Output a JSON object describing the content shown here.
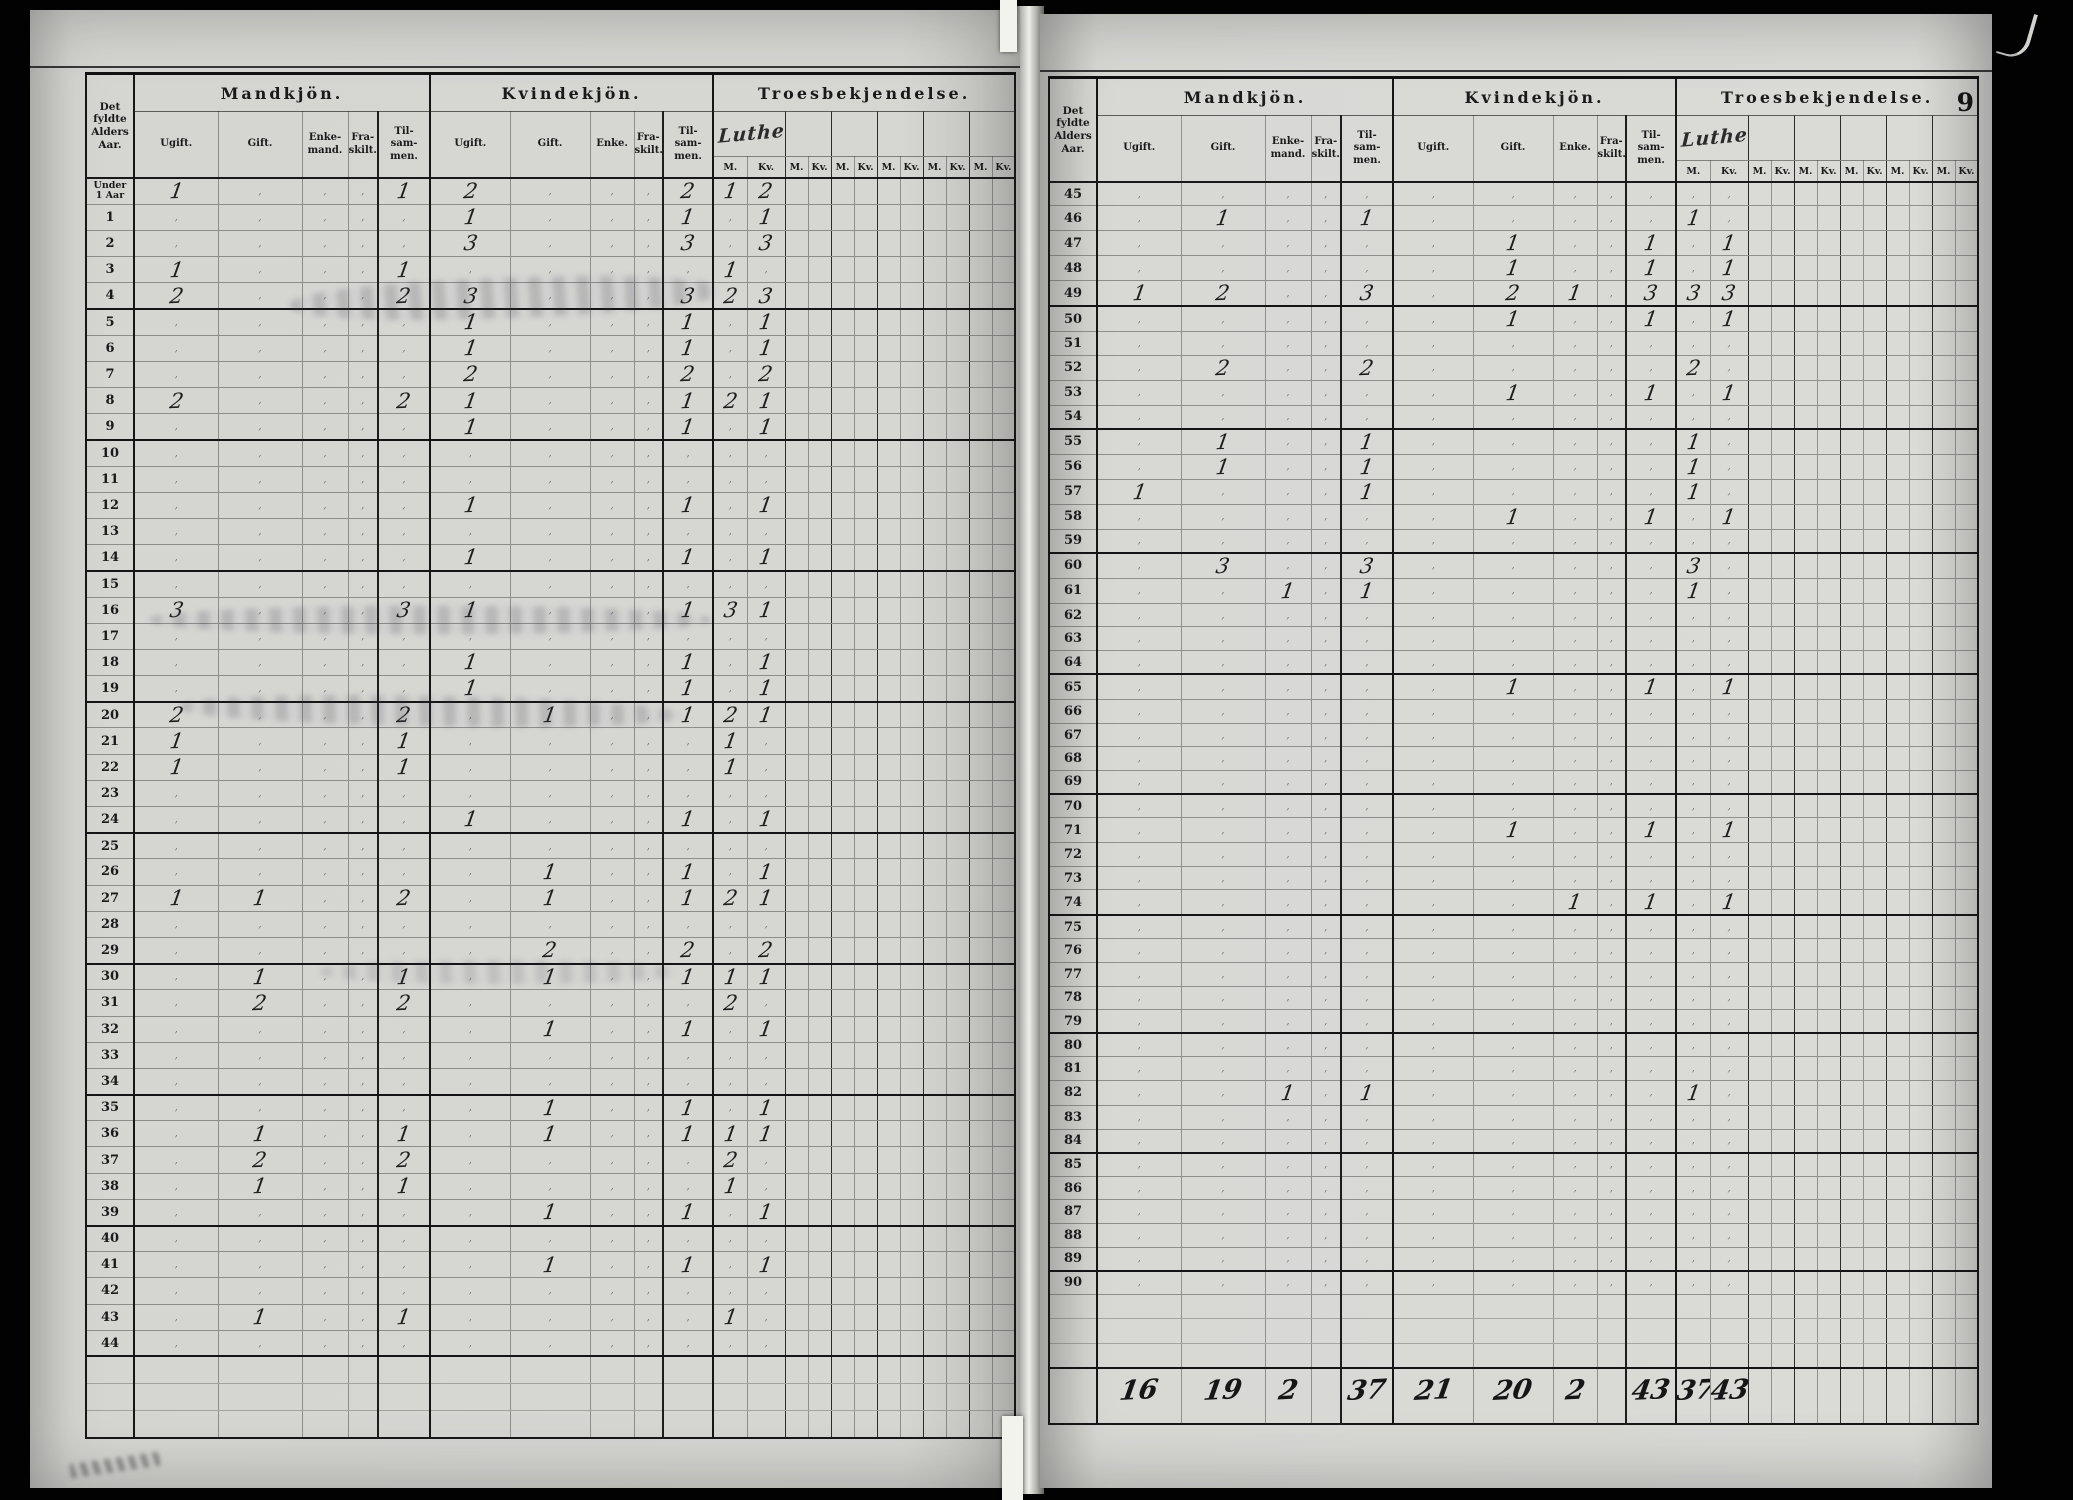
{
  "document": {
    "page_number": "9",
    "age_column_header": "Det\nfyldte\nAlders\nAar.",
    "groups": {
      "male": "Mandkjön.",
      "female": "Kvindekjön.",
      "religion": "Troesbekjendelse."
    },
    "male_subcolumns": [
      "Ugift.",
      "Gift.",
      "Enke-\nmand.",
      "Fra-\nskilt.",
      "Til-\nsam-\nmen."
    ],
    "female_subcolumns": [
      "Ugift.",
      "Gift.",
      "Enke.",
      "Fra-\nskilt.",
      "Til-\nsam-\nmen."
    ],
    "religion_written_label": "Lutheraner",
    "religion_pair_headers": [
      "M.",
      "Kv."
    ],
    "religion_extra_pairs": 5
  },
  "left_page": {
    "rows": [
      {
        "l": "Under\n1 Aar",
        "v": [
          "1",
          "",
          "",
          "",
          "1",
          "2",
          "",
          "",
          "",
          "2",
          "1",
          "2"
        ]
      },
      {
        "l": "1",
        "v": [
          "",
          "",
          "",
          "",
          "",
          "1",
          "",
          "",
          "",
          "1",
          "",
          "1"
        ]
      },
      {
        "l": "2",
        "v": [
          "",
          "",
          "",
          "",
          "",
          "3",
          "",
          "",
          "",
          "3",
          "",
          "3"
        ]
      },
      {
        "l": "3",
        "v": [
          "1",
          "",
          "",
          "",
          "1",
          "",
          "",
          "",
          "",
          "",
          "1",
          ""
        ]
      },
      {
        "l": "4",
        "v": [
          "2",
          "",
          "",
          "",
          "2",
          "3",
          "",
          "",
          "",
          "3",
          "2",
          "3"
        ]
      },
      {
        "l": "5",
        "v": [
          "",
          "",
          "",
          "",
          "",
          "1",
          "",
          "",
          "",
          "1",
          "",
          "1"
        ]
      },
      {
        "l": "6",
        "v": [
          "",
          "",
          "",
          "",
          "",
          "1",
          "",
          "",
          "",
          "1",
          "",
          "1"
        ]
      },
      {
        "l": "7",
        "v": [
          "",
          "",
          "",
          "",
          "",
          "2",
          "",
          "",
          "",
          "2",
          "",
          "2"
        ]
      },
      {
        "l": "8",
        "v": [
          "2",
          "",
          "",
          "",
          "2",
          "1",
          "",
          "",
          "",
          "1",
          "2",
          "1"
        ]
      },
      {
        "l": "9",
        "v": [
          "",
          "",
          "",
          "",
          "",
          "1",
          "",
          "",
          "",
          "1",
          "",
          "1"
        ]
      },
      {
        "l": "10"
      },
      {
        "l": "11"
      },
      {
        "l": "12",
        "v": [
          "",
          "",
          "",
          "",
          "",
          "1",
          "",
          "",
          "",
          "1",
          "",
          "1"
        ]
      },
      {
        "l": "13"
      },
      {
        "l": "14",
        "v": [
          "",
          "",
          "",
          "",
          "",
          "1",
          "",
          "",
          "",
          "1",
          "",
          "1"
        ]
      },
      {
        "l": "15"
      },
      {
        "l": "16",
        "v": [
          "3",
          "",
          "",
          "",
          "3",
          "1",
          "",
          "",
          "",
          "1",
          "3",
          "1"
        ]
      },
      {
        "l": "17"
      },
      {
        "l": "18",
        "v": [
          "",
          "",
          "",
          "",
          "",
          "1",
          "",
          "",
          "",
          "1",
          "",
          "1"
        ]
      },
      {
        "l": "19",
        "v": [
          "",
          "",
          "",
          "",
          "",
          "1",
          "",
          "",
          "",
          "1",
          "",
          "1"
        ]
      },
      {
        "l": "20",
        "v": [
          "2",
          "",
          "",
          "",
          "2",
          "",
          "1",
          "",
          "",
          "1",
          "2",
          "1"
        ]
      },
      {
        "l": "21",
        "v": [
          "1",
          "",
          "",
          "",
          "1",
          "",
          "",
          "",
          "",
          "",
          "1",
          ""
        ]
      },
      {
        "l": "22",
        "v": [
          "1",
          "",
          "",
          "",
          "1",
          "",
          "",
          "",
          "",
          "",
          "1",
          ""
        ]
      },
      {
        "l": "23"
      },
      {
        "l": "24",
        "v": [
          "",
          "",
          "",
          "",
          "",
          "1",
          "",
          "",
          "",
          "1",
          "",
          "1"
        ]
      },
      {
        "l": "25"
      },
      {
        "l": "26",
        "v": [
          "",
          "",
          "",
          "",
          "",
          "",
          "1",
          "",
          "",
          "1",
          "",
          "1"
        ]
      },
      {
        "l": "27",
        "v": [
          "1",
          "1",
          "",
          "",
          "2",
          "",
          "1",
          "",
          "",
          "1",
          "2",
          "1"
        ]
      },
      {
        "l": "28"
      },
      {
        "l": "29",
        "v": [
          "",
          "",
          "",
          "",
          "",
          "",
          "2",
          "",
          "",
          "2",
          "",
          "2"
        ]
      },
      {
        "l": "30",
        "v": [
          "",
          "1",
          "",
          "",
          "1",
          "",
          "1",
          "",
          "",
          "1",
          "1",
          "1"
        ]
      },
      {
        "l": "31",
        "v": [
          "",
          "2",
          "",
          "",
          "2",
          "",
          "",
          "",
          "",
          "",
          "2",
          ""
        ]
      },
      {
        "l": "32",
        "v": [
          "",
          "",
          "",
          "",
          "",
          "",
          "1",
          "",
          "",
          "1",
          "",
          "1"
        ]
      },
      {
        "l": "33"
      },
      {
        "l": "34"
      },
      {
        "l": "35",
        "v": [
          "",
          "",
          "",
          "",
          "",
          "",
          "1",
          "",
          "",
          "1",
          "",
          "1"
        ]
      },
      {
        "l": "36",
        "v": [
          "",
          "1",
          "",
          "",
          "1",
          "",
          "1",
          "",
          "",
          "1",
          "1",
          "1"
        ]
      },
      {
        "l": "37",
        "v": [
          "",
          "2",
          "",
          "",
          "2",
          "",
          "",
          "",
          "",
          "",
          "2",
          ""
        ]
      },
      {
        "l": "38",
        "v": [
          "",
          "1",
          "",
          "",
          "1",
          "",
          "",
          "",
          "",
          "",
          "1",
          ""
        ]
      },
      {
        "l": "39",
        "v": [
          "",
          "",
          "",
          "",
          "",
          "",
          "1",
          "",
          "",
          "1",
          "",
          "1"
        ]
      },
      {
        "l": "40"
      },
      {
        "l": "41",
        "v": [
          "",
          "",
          "",
          "",
          "",
          "",
          "1",
          "",
          "",
          "1",
          "",
          "1"
        ]
      },
      {
        "l": "42"
      },
      {
        "l": "43",
        "v": [
          "",
          "1",
          "",
          "",
          "1",
          "",
          "",
          "",
          "",
          "",
          "1",
          ""
        ]
      },
      {
        "l": "44"
      }
    ]
  },
  "right_page": {
    "rows": [
      {
        "l": "45"
      },
      {
        "l": "46",
        "v": [
          "",
          "1",
          "",
          "",
          "1",
          "",
          "",
          "",
          "",
          "",
          "1",
          ""
        ]
      },
      {
        "l": "47",
        "v": [
          "",
          "",
          "",
          "",
          "",
          "",
          "1",
          "",
          "",
          "1",
          "",
          "1"
        ]
      },
      {
        "l": "48",
        "v": [
          "",
          "",
          "",
          "",
          "",
          "",
          "1",
          "",
          "",
          "1",
          "",
          "1"
        ]
      },
      {
        "l": "49",
        "v": [
          "1",
          "2",
          "",
          "",
          "3",
          "",
          "2",
          "1",
          "",
          "3",
          "3",
          "3"
        ]
      },
      {
        "l": "50",
        "v": [
          "",
          "",
          "",
          "",
          "",
          "",
          "1",
          "",
          "",
          "1",
          "",
          "1"
        ]
      },
      {
        "l": "51"
      },
      {
        "l": "52",
        "v": [
          "",
          "2",
          "",
          "",
          "2",
          "",
          "",
          "",
          "",
          "",
          "2",
          ""
        ]
      },
      {
        "l": "53",
        "v": [
          "",
          "",
          "",
          "",
          "",
          "",
          "1",
          "",
          "",
          "1",
          "",
          "1"
        ]
      },
      {
        "l": "54"
      },
      {
        "l": "55",
        "v": [
          "",
          "1",
          "",
          "",
          "1",
          "",
          "",
          "",
          "",
          "",
          "1",
          ""
        ]
      },
      {
        "l": "56",
        "v": [
          "",
          "1",
          "",
          "",
          "1",
          "",
          "",
          "",
          "",
          "",
          "1",
          ""
        ]
      },
      {
        "l": "57",
        "v": [
          "1",
          "",
          "",
          "",
          "1",
          "",
          "",
          "",
          "",
          "",
          "1",
          ""
        ]
      },
      {
        "l": "58",
        "v": [
          "",
          "",
          "",
          "",
          "",
          "",
          "1",
          "",
          "",
          "1",
          "",
          "1"
        ]
      },
      {
        "l": "59"
      },
      {
        "l": "60",
        "v": [
          "",
          "3",
          "",
          "",
          "3",
          "",
          "",
          "",
          "",
          "",
          "3",
          ""
        ]
      },
      {
        "l": "61",
        "v": [
          "",
          "",
          "1",
          "",
          "1",
          "",
          "",
          "",
          "",
          "",
          "1",
          ""
        ]
      },
      {
        "l": "62"
      },
      {
        "l": "63"
      },
      {
        "l": "64"
      },
      {
        "l": "65",
        "v": [
          "",
          "",
          "",
          "",
          "",
          "",
          "1",
          "",
          "",
          "1",
          "",
          "1"
        ]
      },
      {
        "l": "66"
      },
      {
        "l": "67"
      },
      {
        "l": "68"
      },
      {
        "l": "69"
      },
      {
        "l": "70"
      },
      {
        "l": "71",
        "v": [
          "",
          "",
          "",
          "",
          "",
          "",
          "1",
          "",
          "",
          "1",
          "",
          "1"
        ]
      },
      {
        "l": "72"
      },
      {
        "l": "73"
      },
      {
        "l": "74",
        "v": [
          "",
          "",
          "",
          "",
          "",
          "",
          "",
          "1",
          "",
          "1",
          "",
          "1"
        ]
      },
      {
        "l": "75"
      },
      {
        "l": "76"
      },
      {
        "l": "77"
      },
      {
        "l": "78"
      },
      {
        "l": "79"
      },
      {
        "l": "80"
      },
      {
        "l": "81"
      },
      {
        "l": "82",
        "v": [
          "",
          "",
          "1",
          "",
          "1",
          "",
          "",
          "",
          "",
          "",
          "1",
          ""
        ]
      },
      {
        "l": "83"
      },
      {
        "l": "84"
      },
      {
        "l": "85"
      },
      {
        "l": "86"
      },
      {
        "l": "87"
      },
      {
        "l": "88"
      },
      {
        "l": "89"
      },
      {
        "l": "90"
      }
    ],
    "totals": [
      "16",
      "19",
      "2",
      "",
      "37",
      "21",
      "20",
      "2",
      "",
      "43",
      "37",
      "43"
    ]
  }
}
